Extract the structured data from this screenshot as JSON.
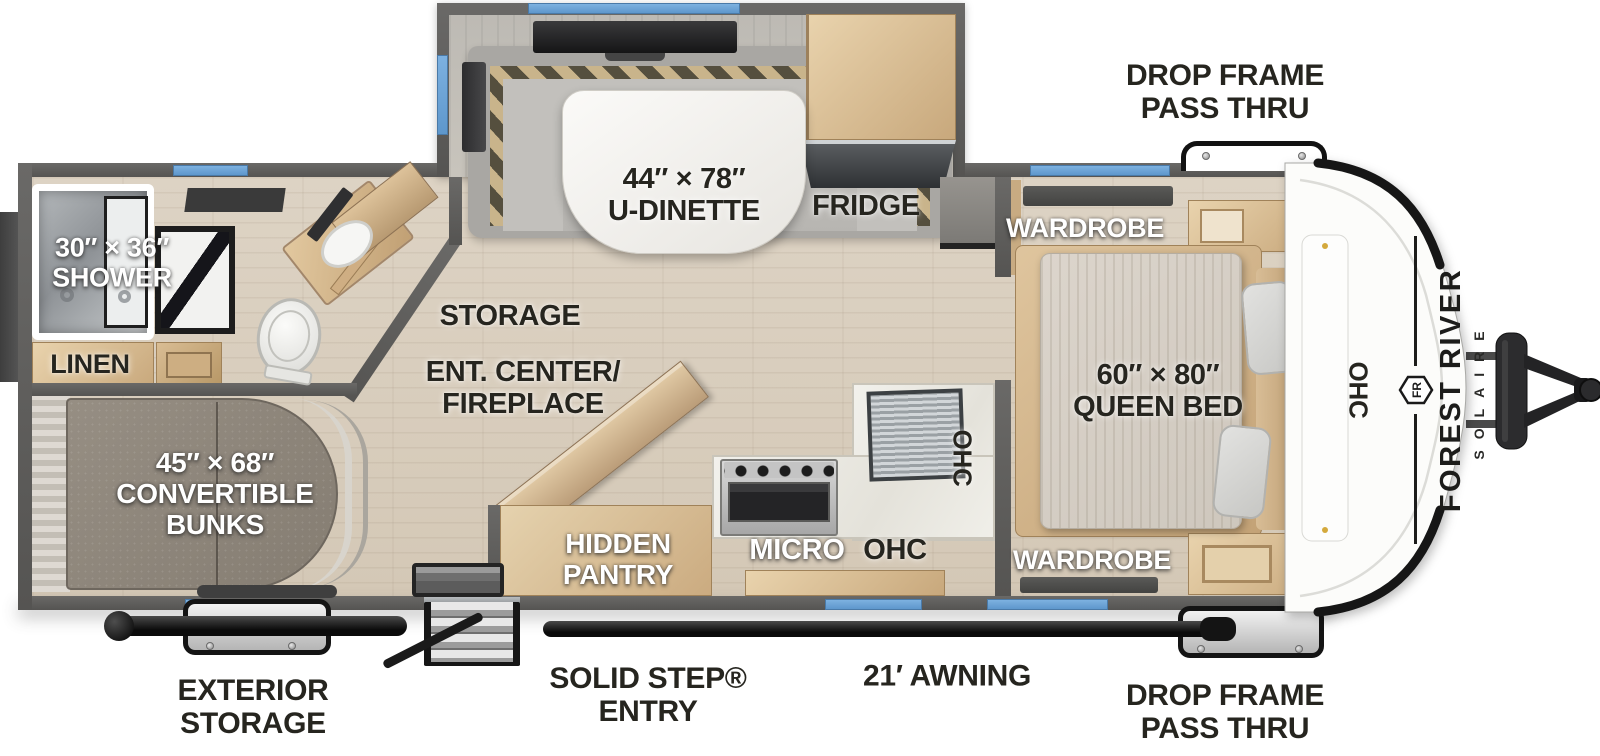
{
  "title": "Forest River Solaire travel trailer floor plan",
  "brand": {
    "name": "FOREST RIVER",
    "sub": "SOLAIRE",
    "emblem": "FR"
  },
  "exterior_labels": {
    "drop_frame_top": "DROP FRAME\nPASS THRU",
    "drop_frame_bottom": "DROP FRAME\nPASS THRU",
    "exterior_storage": "EXTERIOR\nSTORAGE",
    "solid_step_entry": "SOLID STEP®\nENTRY",
    "awning": "21′ AWNING"
  },
  "interior_labels": {
    "dinette": "44″ × 78″\nU-DINETTE",
    "fridge": "FRIDGE",
    "wardrobe_top": "WARDROBE",
    "wardrobe_bottom": "WARDROBE",
    "shower": "30″ × 36″\nSHOWER",
    "linen": "LINEN",
    "storage": "STORAGE",
    "ent_center": "ENT. CENTER/\nFIREPLACE",
    "queen_bed": "60″ × 80″\nQUEEN BED",
    "bunks": "45″ × 68″\nCONVERTIBLE\nBUNKS",
    "hidden_pantry": "HIDDEN\nPANTRY",
    "micro": "MICRO",
    "ohc_kitchen": "OHC",
    "ohc_kitchen_wall": "OHC",
    "ohc_front": "OHC"
  },
  "colors": {
    "wall": "#5d5c5a",
    "window_blue": "#6aa3d8",
    "floor": "#d9cec0",
    "cabinet_tan": "#d7bd97",
    "label_dark": "#26251f",
    "label_light": "#ffffff"
  }
}
